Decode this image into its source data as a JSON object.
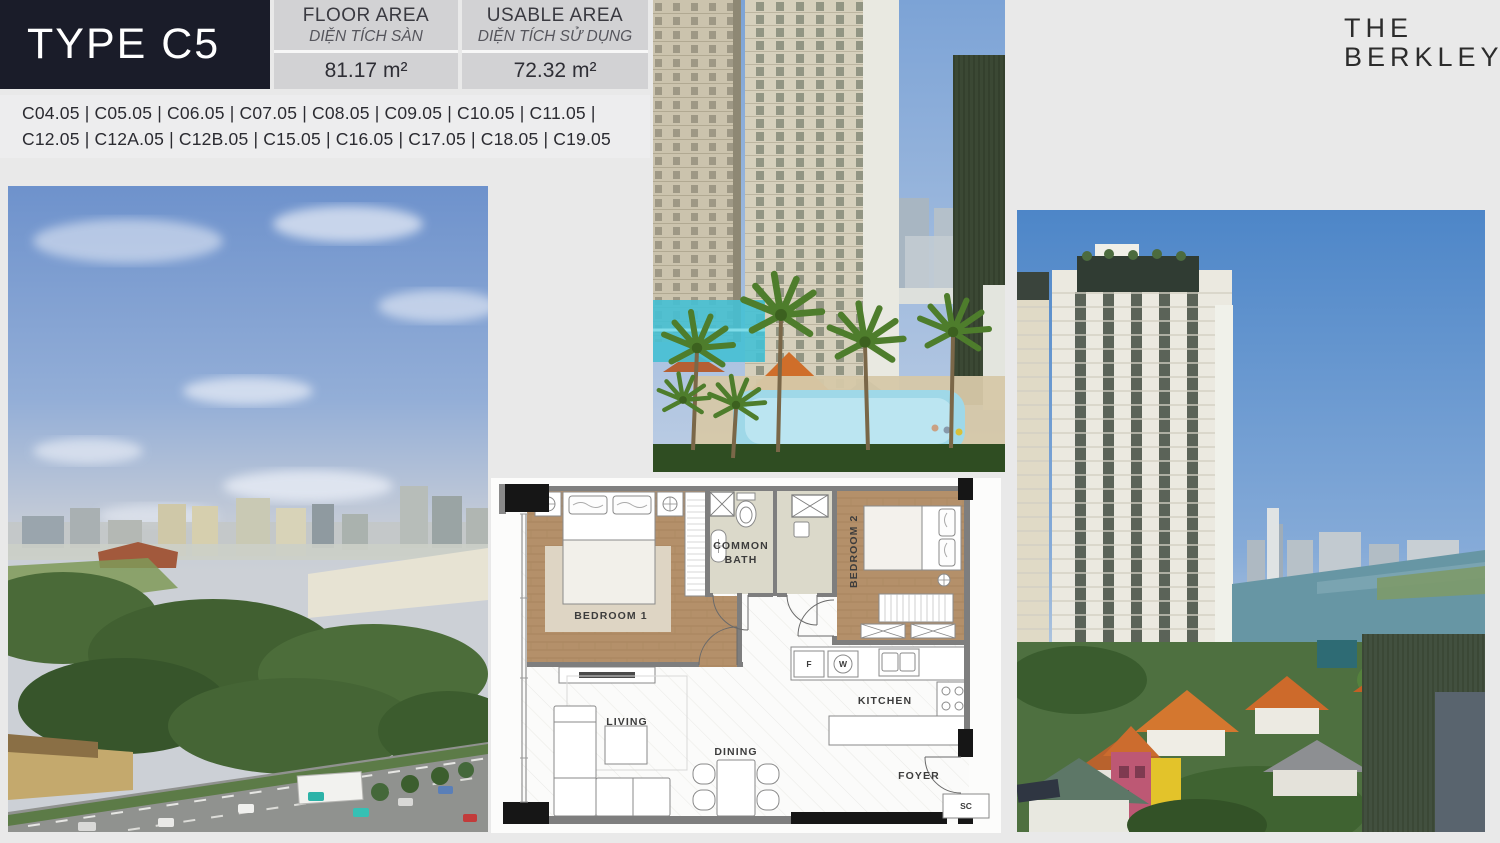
{
  "title_block": {
    "label": "TYPE C5"
  },
  "area_table": {
    "floor": {
      "label_en": "FLOOR AREA",
      "label_vi": "DIỆN TÍCH SÀN",
      "value": "81.17 m²"
    },
    "usable": {
      "label_en": "USABLE AREA",
      "label_vi": "DIỆN TÍCH SỬ DỤNG",
      "value": "72.32 m²"
    }
  },
  "units": {
    "line1": "C04.05 | C05.05 | C06.05 | C07.05 | C08.05 | C09.05 | C10.05 | C11.05 |",
    "line2": "C12.05 | C12A.05 | C12B.05 | C15.05 | C16.05 | C17.05 | C18.05 | C19.05"
  },
  "brand": {
    "line1": "THE",
    "line2": "BERKLEY"
  },
  "floorplan": {
    "bedroom1": "BEDROOM 1",
    "bedroom2": "BEDROOM 2",
    "bath_line1": "COMMON",
    "bath_line2": "BATH",
    "kitchen": "KITCHEN",
    "living": "LIVING",
    "dining": "DINING",
    "foyer": "FOYER",
    "fridge": "F",
    "washer": "W",
    "shoe_cabinet": "SC"
  },
  "photos": {
    "left": "city-skyline-park-highway-view",
    "center": "pool-courtyard-palm-trees",
    "right": "tower-river-houses-view"
  },
  "colors": {
    "navy_header": "#1a1c29",
    "panel_gray": "#d2d2d4",
    "units_bar": "#ededee",
    "page_background": "#e9e9e9",
    "plan_wood": "#b4906a",
    "plan_bath": "#dbd9ca",
    "plan_wall": "#7e7e7e",
    "pool_blue": "#9fd8e8"
  }
}
